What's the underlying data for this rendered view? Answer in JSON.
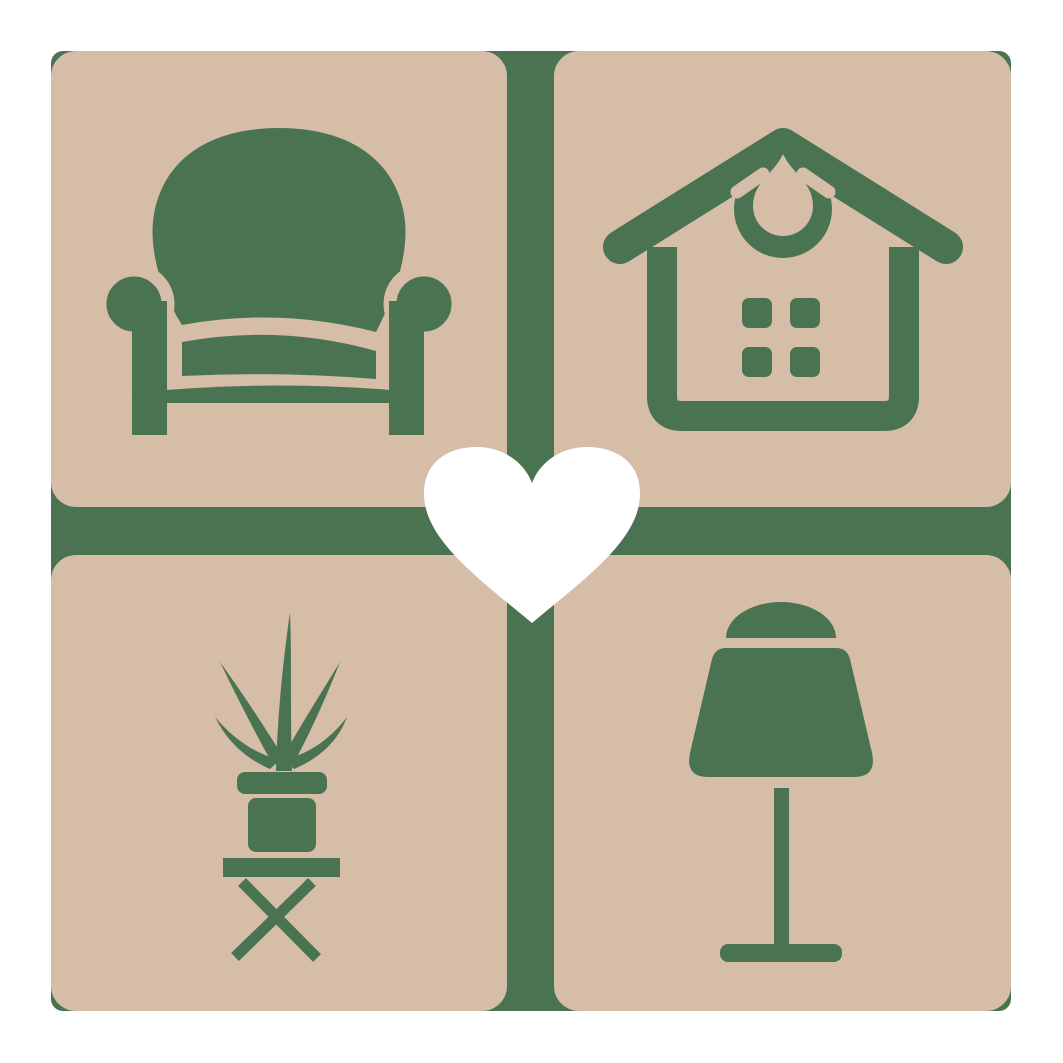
{
  "logo": {
    "alt": "Home furnishing logo: four rounded squares with armchair, house, potted plant and table lamp glyphs around a central heart",
    "colors": {
      "canvas": "#ffffff",
      "tile": "#d5bda8",
      "glyph": "#4a7351",
      "heart": "#ffffff"
    },
    "quadrants": [
      {
        "position": "top-left",
        "icon": "armchair-icon"
      },
      {
        "position": "top-right",
        "icon": "house-icon"
      },
      {
        "position": "bottom-left",
        "icon": "potted-plant-icon"
      },
      {
        "position": "bottom-right",
        "icon": "table-lamp-icon"
      }
    ],
    "center_icon": "heart-icon"
  }
}
